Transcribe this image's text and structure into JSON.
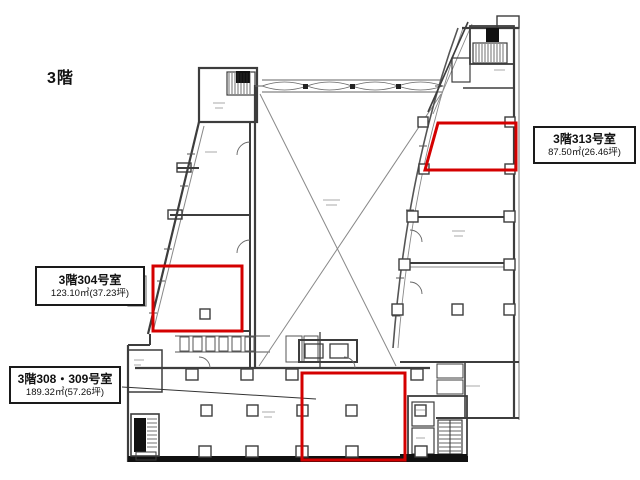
{
  "floor_label": "3階",
  "highlights": [
    {
      "id": "room-313",
      "name": "3階313号室",
      "area": "87.50㎡(26.46坪)"
    },
    {
      "id": "room-304",
      "name": "3階304号室",
      "area": "123.10㎡(37.23坪)"
    },
    {
      "id": "room-308-309",
      "name": "3階308・309号室",
      "area": "189.32㎡(57.26坪)"
    }
  ],
  "colors": {
    "highlight_red": "#d40000",
    "wall_dark": "#3d3d3d",
    "background": "#ffffff"
  }
}
